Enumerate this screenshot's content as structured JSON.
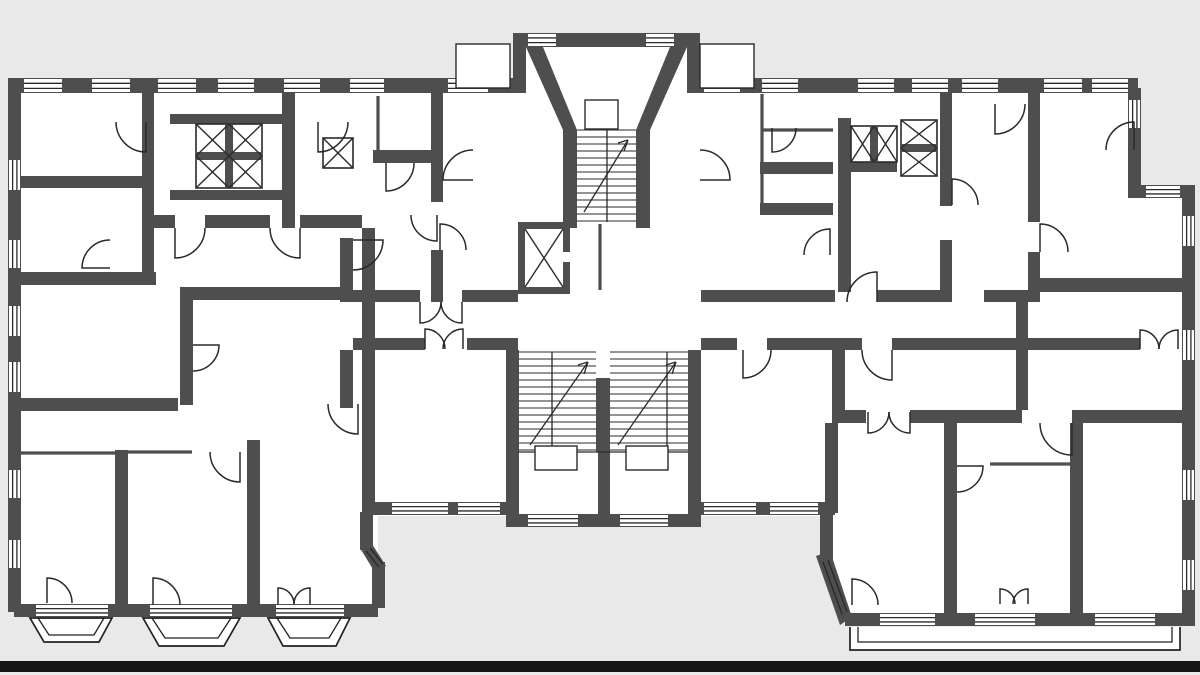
{
  "meta": {
    "canvas": {
      "w": 1200,
      "h": 675
    }
  },
  "palette": {
    "bg": "#e9e9e9",
    "wall": "#4e4e4e",
    "line": "#222222",
    "fine": "#2a2a2a",
    "white": "#ffffff",
    "scan_bar": "#141414"
  },
  "plan": {
    "white_areas": [
      [
        14,
        80,
        1122,
        436
      ],
      [
        1136,
        195,
        52,
        321
      ],
      [
        14,
        515,
        364,
        102
      ],
      [
        820,
        515,
        368,
        111
      ],
      [
        513,
        35,
        185,
        58
      ],
      [
        506,
        515,
        195,
        12
      ]
    ],
    "gray_patches": [
      "818,562 845,626 818,626"
    ],
    "walls": [
      [
        8,
        78,
        505,
        15
      ],
      [
        697,
        78,
        441,
        15
      ],
      [
        8,
        78,
        13,
        534
      ],
      [
        1128,
        88,
        13,
        104
      ],
      [
        1128,
        185,
        67,
        13
      ],
      [
        1182,
        185,
        13,
        441
      ],
      [
        845,
        613,
        350,
        13
      ],
      [
        820,
        512,
        13,
        50
      ],
      [
        695,
        502,
        140,
        13
      ],
      [
        506,
        350,
        13,
        177
      ],
      [
        688,
        350,
        13,
        177
      ],
      [
        506,
        514,
        195,
        13
      ],
      [
        372,
        502,
        147,
        13
      ],
      [
        360,
        512,
        13,
        38
      ],
      [
        372,
        562,
        13,
        46
      ],
      [
        14,
        604,
        364,
        13
      ],
      [
        513,
        33,
        187,
        14
      ],
      [
        513,
        33,
        13,
        60
      ],
      [
        687,
        33,
        13,
        60
      ],
      [
        142,
        92,
        12,
        86
      ],
      [
        14,
        176,
        140,
        12
      ],
      [
        14,
        272,
        142,
        13
      ],
      [
        282,
        92,
        13,
        136
      ],
      [
        150,
        215,
        25,
        13
      ],
      [
        205,
        215,
        65,
        13
      ],
      [
        300,
        215,
        62,
        13
      ],
      [
        431,
        92,
        12,
        110
      ],
      [
        431,
        250,
        12,
        52
      ],
      [
        373,
        150,
        70,
        13
      ],
      [
        182,
        287,
        161,
        13
      ],
      [
        340,
        238,
        13,
        64
      ],
      [
        340,
        350,
        13,
        58
      ],
      [
        180,
        287,
        13,
        118
      ],
      [
        14,
        398,
        164,
        13
      ],
      [
        115,
        450,
        13,
        154
      ],
      [
        247,
        440,
        13,
        164
      ],
      [
        142,
        176,
        12,
        109
      ],
      [
        362,
        228,
        13,
        284
      ],
      [
        838,
        118,
        13,
        174
      ],
      [
        851,
        162,
        46,
        10
      ],
      [
        940,
        92,
        12,
        114
      ],
      [
        940,
        240,
        12,
        62
      ],
      [
        1028,
        92,
        12,
        130
      ],
      [
        1028,
        252,
        12,
        40
      ],
      [
        1040,
        278,
        148,
        14
      ],
      [
        353,
        290,
        67,
        12
      ],
      [
        462,
        290,
        56,
        12
      ],
      [
        701,
        290,
        134,
        12
      ],
      [
        877,
        290,
        63,
        12
      ],
      [
        984,
        290,
        56,
        12
      ],
      [
        353,
        338,
        72,
        12
      ],
      [
        467,
        338,
        51,
        12
      ],
      [
        701,
        338,
        36,
        12
      ],
      [
        767,
        338,
        95,
        12
      ],
      [
        892,
        338,
        148,
        12
      ],
      [
        1040,
        338,
        100,
        12
      ],
      [
        832,
        410,
        34,
        13
      ],
      [
        910,
        410,
        112,
        13
      ],
      [
        1072,
        410,
        112,
        13
      ],
      [
        1016,
        292,
        12,
        118
      ],
      [
        944,
        423,
        13,
        190
      ],
      [
        1070,
        423,
        13,
        190
      ],
      [
        832,
        350,
        13,
        60
      ],
      [
        825,
        423,
        13,
        90
      ],
      [
        760,
        162,
        73,
        12
      ],
      [
        760,
        203,
        73,
        12
      ],
      [
        170,
        114,
        125,
        10
      ],
      [
        170,
        190,
        125,
        10
      ],
      [
        518,
        222,
        52,
        7
      ],
      [
        518,
        287,
        52,
        7
      ],
      [
        518,
        222,
        7,
        72
      ],
      [
        563,
        222,
        7,
        30
      ],
      [
        563,
        262,
        7,
        32
      ],
      [
        596,
        378,
        14,
        74
      ],
      [
        598,
        452,
        12,
        62
      ]
    ],
    "wall_polys": [
      "526,47 543,47 577,130 577,228 563,228 563,130",
      "687,47 670,47 636,130 636,228 650,228 650,130",
      "816,556 830,551 852,617 840,625",
      "360,548 372,544 386,566 374,571"
    ],
    "windows": [
      [
        24,
        79,
        38,
        13,
        "h"
      ],
      [
        92,
        79,
        38,
        13,
        "h"
      ],
      [
        158,
        79,
        38,
        13,
        "h"
      ],
      [
        218,
        79,
        36,
        13,
        "h"
      ],
      [
        284,
        79,
        36,
        13,
        "h"
      ],
      [
        350,
        79,
        34,
        13,
        "h"
      ],
      [
        448,
        79,
        40,
        13,
        "h"
      ],
      [
        704,
        79,
        36,
        13,
        "h"
      ],
      [
        762,
        79,
        36,
        13,
        "h"
      ],
      [
        858,
        79,
        36,
        13,
        "h"
      ],
      [
        912,
        79,
        36,
        13,
        "h"
      ],
      [
        962,
        79,
        36,
        13,
        "h"
      ],
      [
        1044,
        79,
        38,
        13,
        "h"
      ],
      [
        1092,
        79,
        36,
        13,
        "h"
      ],
      [
        528,
        34,
        28,
        12,
        "h"
      ],
      [
        646,
        34,
        28,
        12,
        "h"
      ],
      [
        1146,
        186,
        34,
        11,
        "h"
      ],
      [
        9,
        160,
        11,
        30,
        "v"
      ],
      [
        9,
        240,
        11,
        28,
        "v"
      ],
      [
        9,
        306,
        11,
        30,
        "v"
      ],
      [
        9,
        362,
        11,
        30,
        "v"
      ],
      [
        9,
        470,
        11,
        28,
        "v"
      ],
      [
        9,
        540,
        11,
        28,
        "v"
      ],
      [
        1183,
        216,
        11,
        30,
        "v"
      ],
      [
        1183,
        330,
        11,
        30,
        "v"
      ],
      [
        1183,
        470,
        11,
        30,
        "v"
      ],
      [
        1183,
        560,
        11,
        30,
        "v"
      ],
      [
        1129,
        100,
        11,
        28,
        "v"
      ],
      [
        880,
        614,
        55,
        11,
        "h"
      ],
      [
        975,
        614,
        60,
        11,
        "h"
      ],
      [
        1095,
        614,
        60,
        11,
        "h"
      ],
      [
        528,
        515,
        50,
        11,
        "h"
      ],
      [
        620,
        515,
        48,
        11,
        "h"
      ],
      [
        392,
        503,
        56,
        11,
        "h"
      ],
      [
        458,
        503,
        42,
        11,
        "h"
      ],
      [
        704,
        503,
        52,
        11,
        "h"
      ],
      [
        770,
        503,
        48,
        11,
        "h"
      ],
      [
        36,
        605,
        72,
        11,
        "h"
      ],
      [
        150,
        605,
        82,
        11,
        "h"
      ],
      [
        276,
        605,
        68,
        11,
        "h"
      ]
    ],
    "partitions": [
      [
        762,
        94,
        762,
        203
      ],
      [
        762,
        130,
        833,
        130
      ],
      [
        990,
        464,
        1070,
        464
      ],
      [
        20,
        453,
        115,
        453
      ],
      [
        128,
        452,
        192,
        452
      ],
      [
        378,
        96,
        378,
        150
      ],
      [
        600,
        224,
        600,
        290
      ]
    ],
    "fine_lines": [
      [
        525,
        229,
        563,
        287
      ],
      [
        563,
        229,
        525,
        287
      ],
      [
        823,
        562,
        842,
        614
      ],
      [
        828,
        560,
        847,
        612
      ],
      [
        366,
        551,
        379,
        567
      ],
      [
        370,
        548,
        383,
        564
      ]
    ],
    "xboxes": [
      {
        "x": 196,
        "y": 124,
        "w": 66,
        "h": 64,
        "cols": 2,
        "rows": 2
      },
      {
        "x": 323,
        "y": 138,
        "w": 30,
        "h": 30,
        "cols": 1,
        "rows": 1
      },
      {
        "x": 851,
        "y": 126,
        "w": 46,
        "h": 36,
        "cols": 2,
        "rows": 1
      },
      {
        "x": 901,
        "y": 120,
        "w": 36,
        "h": 56,
        "cols": 1,
        "rows": 2
      }
    ],
    "stairs": [
      {
        "x": 577,
        "y": 130,
        "w": 59,
        "h": 92,
        "step": 7
      },
      {
        "x": 519,
        "y": 352,
        "w": 77,
        "h": 100,
        "step": 7
      },
      {
        "x": 610,
        "y": 352,
        "w": 78,
        "h": 100,
        "step": 7
      }
    ],
    "stair_lines": [
      [
        607,
        130,
        607,
        222
      ],
      [
        552,
        352,
        552,
        452
      ],
      [
        667,
        352,
        667,
        452
      ],
      [
        518,
        452,
        688,
        452
      ],
      [
        584,
        212,
        628,
        140
      ],
      [
        628,
        140,
        618,
        143
      ],
      [
        628,
        140,
        624,
        151
      ],
      [
        530,
        445,
        588,
        362
      ],
      [
        588,
        362,
        578,
        365
      ],
      [
        588,
        362,
        584,
        374
      ],
      [
        618,
        445,
        676,
        362
      ],
      [
        676,
        362,
        666,
        365
      ],
      [
        676,
        362,
        672,
        374
      ]
    ],
    "thin_rects": [
      [
        456,
        44,
        54,
        44
      ],
      [
        700,
        44,
        54,
        44
      ],
      [
        585,
        100,
        33,
        29
      ],
      [
        535,
        446,
        42,
        24
      ],
      [
        626,
        446,
        42,
        24
      ]
    ],
    "balconies": [
      {
        "outer": "30,618 112,618 99,642 44,642",
        "inner": "38,618 104,618 94,635 49,635"
      },
      {
        "outer": "143,618 240,618 224,646 159,646",
        "inner": "152,618 231,618 218,638 165,638"
      },
      {
        "outer": "268,618 350,618 336,646 283,646",
        "inner": "277,618 341,618 329,638 290,638"
      }
    ],
    "terrace": {
      "outer": "850,627 850,650 1180,650 1180,627",
      "inner": "858,627 858,642 1172,642 1172,627"
    },
    "doors": [
      [
        146,
        122,
        30,
        90,
        180
      ],
      [
        318,
        122,
        30,
        90,
        0
      ],
      [
        175,
        228,
        30,
        90,
        0
      ],
      [
        300,
        228,
        30,
        90,
        180
      ],
      [
        110,
        268,
        28,
        180,
        270
      ],
      [
        386,
        163,
        28,
        90,
        0
      ],
      [
        437,
        215,
        26,
        90,
        180
      ],
      [
        440,
        250,
        26,
        270,
        0
      ],
      [
        353,
        240,
        30,
        0,
        90
      ],
      [
        358,
        404,
        30,
        90,
        180
      ],
      [
        193,
        345,
        26,
        0,
        90
      ],
      [
        240,
        452,
        30,
        90,
        180
      ],
      [
        47,
        603,
        25,
        270,
        0
      ],
      [
        153,
        605,
        27,
        270,
        0
      ],
      [
        278,
        604,
        16,
        270,
        0
      ],
      [
        310,
        604,
        16,
        270,
        180
      ],
      [
        425,
        349,
        20,
        270,
        0
      ],
      [
        463,
        349,
        20,
        270,
        180
      ],
      [
        420,
        302,
        21,
        90,
        0
      ],
      [
        462,
        302,
        21,
        90,
        180
      ],
      [
        473,
        180,
        30,
        180,
        270
      ],
      [
        700,
        180,
        30,
        0,
        270
      ],
      [
        743,
        350,
        28,
        90,
        0
      ],
      [
        892,
        350,
        30,
        90,
        180
      ],
      [
        877,
        302,
        30,
        270,
        180
      ],
      [
        952,
        205,
        26,
        270,
        0
      ],
      [
        995,
        104,
        30,
        90,
        0
      ],
      [
        772,
        128,
        24,
        90,
        0
      ],
      [
        830,
        255,
        26,
        270,
        180
      ],
      [
        1134,
        150,
        28,
        270,
        180
      ],
      [
        1040,
        252,
        28,
        270,
        0
      ],
      [
        1072,
        423,
        32,
        90,
        180
      ],
      [
        957,
        466,
        26,
        0,
        90
      ],
      [
        868,
        412,
        21,
        90,
        0
      ],
      [
        910,
        412,
        21,
        90,
        180
      ],
      [
        1140,
        349,
        19,
        270,
        0
      ],
      [
        1178,
        349,
        19,
        270,
        180
      ],
      [
        852,
        605,
        26,
        270,
        0
      ],
      [
        1000,
        604,
        15,
        270,
        0
      ],
      [
        1028,
        604,
        15,
        270,
        180
      ]
    ],
    "scan_bar": [
      0,
      661,
      1200,
      11
    ]
  }
}
